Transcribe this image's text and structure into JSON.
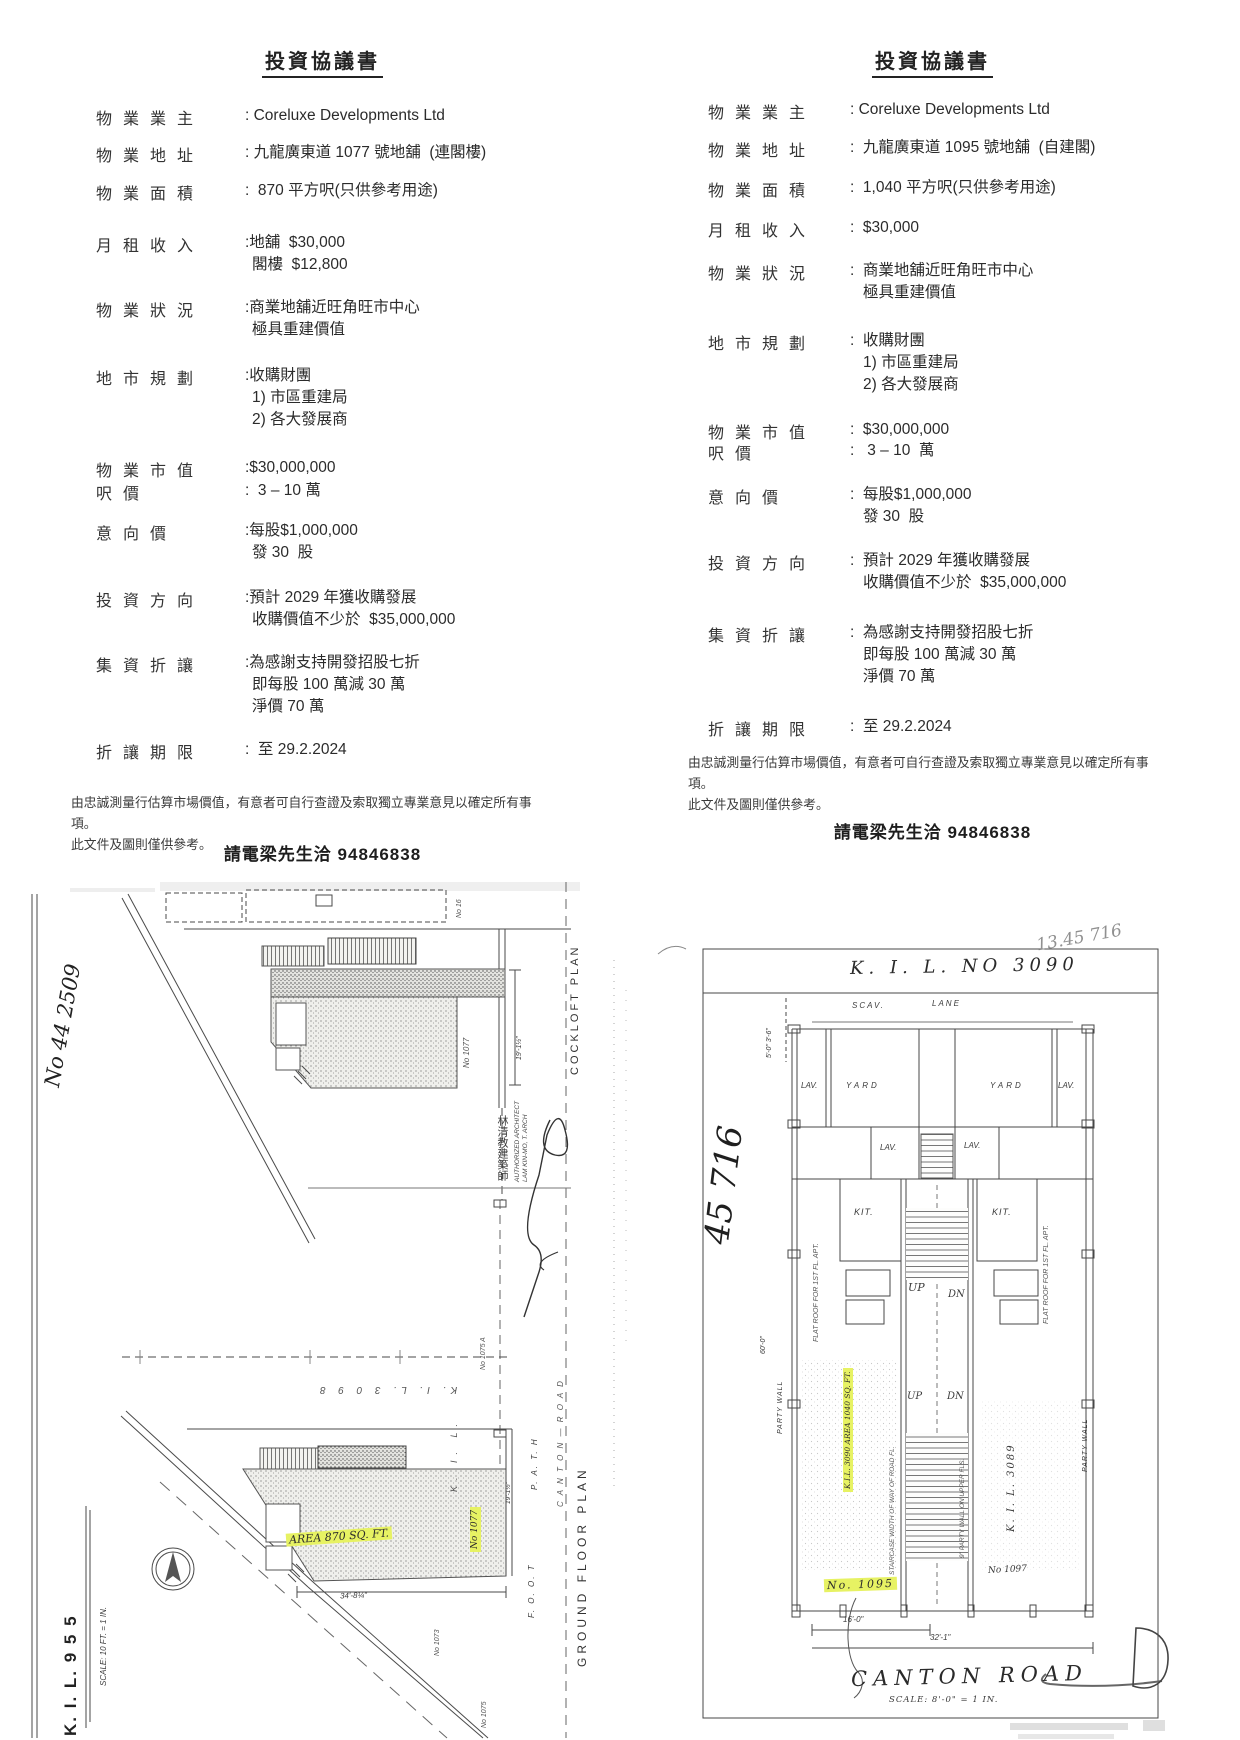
{
  "doc_left": {
    "title": "投資協議書",
    "rows": [
      {
        "label": "物業業主",
        "lines": [
          ": Coreluxe Developments Ltd"
        ]
      },
      {
        "label": "物業地址",
        "lines": [
          ": 九龍廣東道 1077 號地舖  (連閣樓)"
        ]
      },
      {
        "label": "物業面積",
        "lines": [
          ":  870 平方呎(只供參考用途)"
        ]
      },
      {
        "label": "月租收入",
        "lines": [
          ":地舖  $30,000",
          "閣樓  $12,800"
        ]
      },
      {
        "label": "物業狀況",
        "lines": [
          ":商業地舖近旺角旺市中心",
          "極具重建價值"
        ]
      },
      {
        "label": "地市規劃",
        "lines": [
          ":收購財團",
          "1) 市區重建局",
          "2) 各大發展商"
        ]
      },
      {
        "label": "物業市值",
        "lines": [
          ":$30,000,000"
        ]
      },
      {
        "label": "呎價",
        "lines": [
          ":  3 – 10 萬"
        ]
      },
      {
        "label": "意向價",
        "lines": [
          ":每股$1,000,000",
          "發 30  股"
        ]
      },
      {
        "label": "投資方向",
        "lines": [
          ":預計 2029 年獲收購發展",
          "收購價值不少於  $35,000,000"
        ]
      },
      {
        "label": "集資折讓",
        "lines": [
          ":為感謝支持開發招股七折",
          "即每股 100 萬減 30 萬",
          "淨價 70 萬"
        ]
      },
      {
        "label": "折讓期限",
        "lines": [
          ":  至 29.2.2024"
        ]
      }
    ]
  },
  "doc_right": {
    "title": "投資協議書",
    "rows": [
      {
        "label": "物業業主",
        "lines": [
          ": Coreluxe Developments Ltd"
        ]
      },
      {
        "label": "物業地址",
        "lines": [
          ":  九龍廣東道 1095 號地舖  (自建閣)"
        ]
      },
      {
        "label": "物業面積",
        "lines": [
          ":  1,040 平方呎(只供參考用途)"
        ]
      },
      {
        "label": "月租收入",
        "lines": [
          ":  $30,000"
        ]
      },
      {
        "label": "物業狀況",
        "lines": [
          ":  商業地舖近旺角旺市中心",
          "極具重建價值"
        ]
      },
      {
        "label": "地市規劃",
        "lines": [
          ":  收購財團",
          "1) 市區重建局",
          "2) 各大發展商"
        ]
      },
      {
        "label": "物業市值",
        "lines": [
          ":  $30,000,000"
        ]
      },
      {
        "label": "呎價",
        "lines": [
          ":   3 – 10  萬"
        ]
      },
      {
        "label": "意向價",
        "lines": [
          ":  每股$1,000,000",
          "發 30  股"
        ]
      },
      {
        "label": "投資方向",
        "lines": [
          ":  預計 2029 年獲收購發展",
          "收購價值不少於  $35,000,000"
        ]
      },
      {
        "label": "集資折讓",
        "lines": [
          ":  為感謝支持開發招股七折",
          "即每股 100 萬減 30 萬",
          "淨價 70 萬"
        ]
      },
      {
        "label": "折讓期限",
        "lines": [
          ":  至 29.2.2024"
        ]
      }
    ]
  },
  "disclaimer": {
    "line1": "由忠誠測量行估算市場價值，有意者可自行查證及索取獨立專業意見以確定所有事項。",
    "line2": "此文件及圖則僅供參考。"
  },
  "contact": "請電梁先生洽 94846838",
  "drawing_left": {
    "cockloft_plan": "COCKLOFT  PLAN",
    "ground_floor_plan": "GROUND  FLOOR  PLAN",
    "kil_955": "K. I. L.  9 5 5",
    "scale_note": "SCALE: 10 FT. = 1 IN.",
    "survey_no": "No 44 2509",
    "architect_line1": "AUTHORIZED ARCHITECT",
    "architect_line2": "LAM KIN-MO, T. ARCH",
    "architect_cn": "林清教建築師",
    "kil_3098": "K. I. L.  3 0 9 8",
    "area_highlight": "AREA 870 SQ. FT.",
    "lot_no_16": "No 16",
    "lot_no_1077": "No 1077",
    "lot_no_1075a": "No 1075 A",
    "lot_no_1073": "No 1073",
    "lot_no_1075": "No 1075",
    "kil_letters": "K.  I.  L.",
    "path_label": "P. A. T. H",
    "foot_label": "F. O. O. T",
    "canton_road": "C A N T O N — R O A D",
    "dim_19": "19'-1½\"",
    "dim_34": "34'-8¼\""
  },
  "drawing_right": {
    "title": "K. I. L.  NO  3090",
    "pencil_note": "13.45 716",
    "hand_no": "45 716",
    "scav": "SCAV.",
    "lane": "LANE",
    "lav": "LAV.",
    "yard": "YARD",
    "kit": "KIT.",
    "up": "UP",
    "dn": "DN",
    "flat_roof": "FLAT ROOF FOR 1ST FL. APT.",
    "dim_top": "5'-0\"  3'-6\"",
    "dim_60": "60'-0\"",
    "dim_16": "16'-0\"",
    "dim_32": "32'-1\"",
    "party_wall": "PARTY WALL",
    "staircase_note": "STAIRCASE WIDTH OF WAY OF ROAD FL.",
    "party_wall_note": "9\" PARTY WALL ON UPPER FLS.",
    "kil_3089": "K. I. L. 3089",
    "lot_no_1097": "No 1097",
    "area_highlight": "K.I.L. 3090  AREA 1040 SQ. FT.",
    "no_highlight": "No. 1095",
    "canton_road": "CANTON  ROAD",
    "scale_note": "SCALE: 8'-0\" = 1 IN."
  },
  "colors": {
    "highlight": "#e7f263",
    "ink": "#3c3c3c",
    "pencil": "#8a8a8a"
  }
}
